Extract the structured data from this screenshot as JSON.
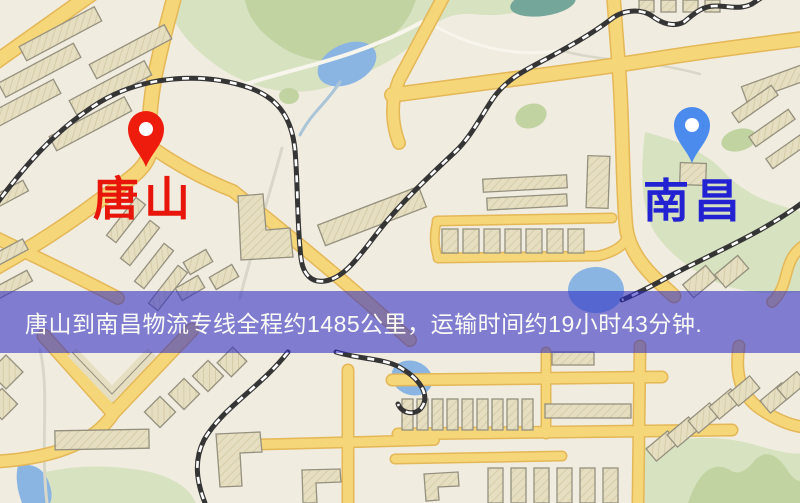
{
  "banner": {
    "text": "唐山到南昌物流专线全程约1485公里，运输时间约19小时43分钟.",
    "background_color": "#2f2cc5",
    "text_color": "#fbfbf6"
  },
  "route": {
    "origin": "唐山",
    "destination": "南昌",
    "distance_text": "约1485公里",
    "duration_text": "约19小时43分钟"
  },
  "markers": {
    "origin": {
      "label": "唐山",
      "label_color": "#e8150a",
      "pin_color": "#ee1c0c"
    },
    "destination": {
      "label": "南昌",
      "label_color": "#2322d2",
      "pin_color": "#4b8bee"
    }
  },
  "map": {
    "style": "street-map",
    "colors": {
      "background": "#f1ece0",
      "main_road": "#f5d678",
      "road_casing": "#e4b757",
      "park": "#d7e2c0",
      "water": "#8ab5e2",
      "building": "#e6dec1",
      "railway": "#353535"
    }
  }
}
